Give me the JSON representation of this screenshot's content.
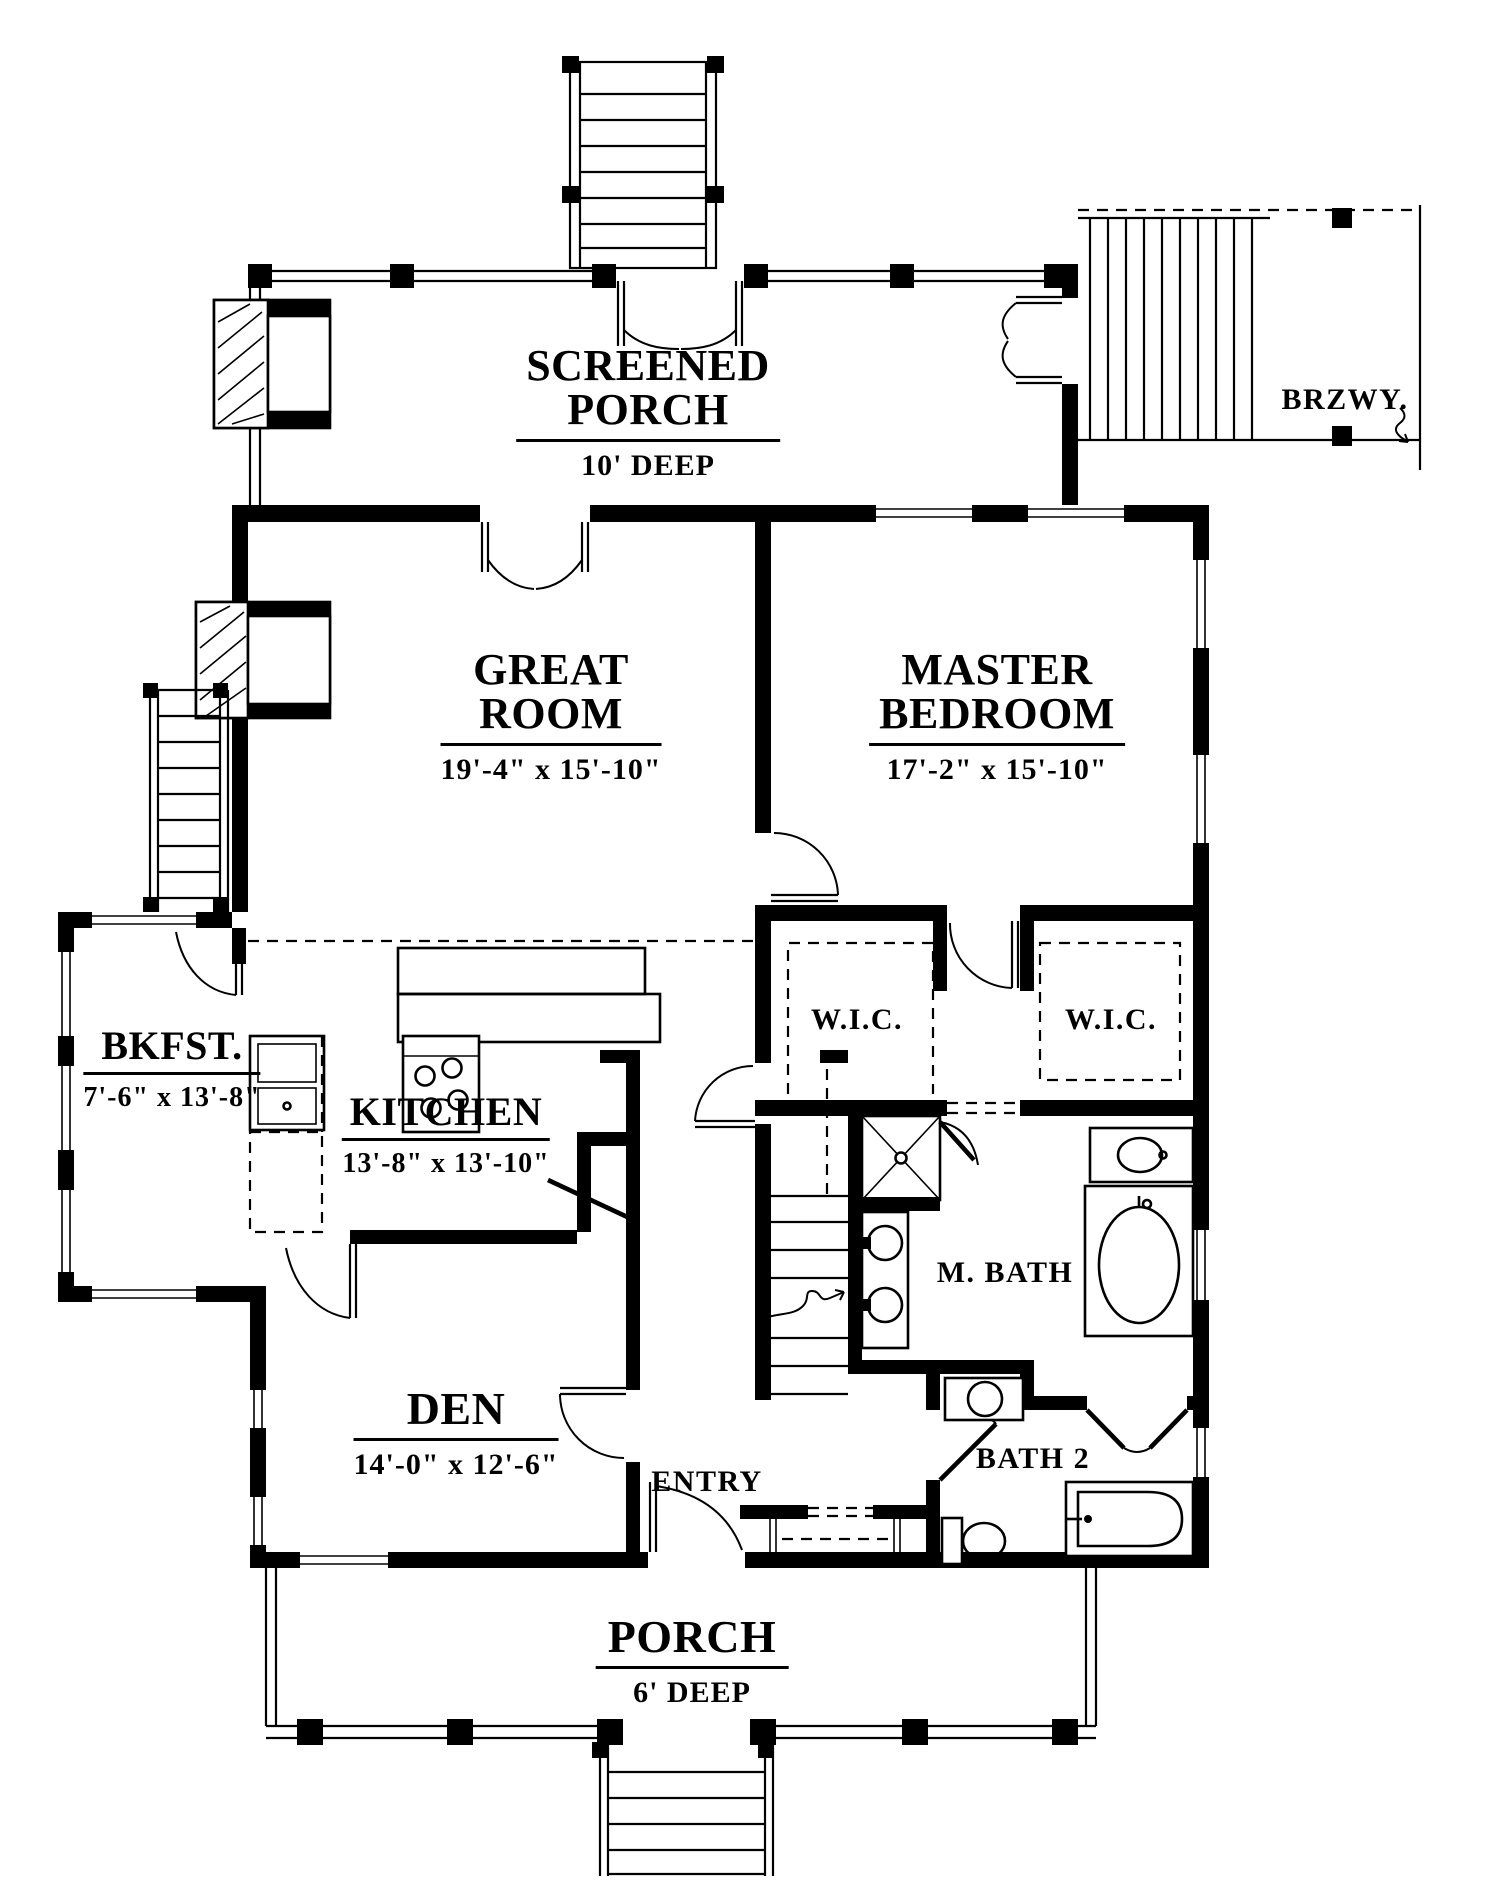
{
  "plan": {
    "colors": {
      "ink": "#000000",
      "paper": "#ffffff"
    },
    "rooms": {
      "screened_porch": {
        "line1": "SCREENED",
        "line2": "PORCH",
        "dims": "10' DEEP"
      },
      "brzwy": {
        "name": "BRZWY."
      },
      "great_room": {
        "line1": "GREAT",
        "line2": "ROOM",
        "dims": "19'-4\" x 15'-10\""
      },
      "master_bedroom": {
        "line1": "MASTER",
        "line2": "BEDROOM",
        "dims": "17'-2\" x 15'-10\""
      },
      "bkfst": {
        "name": "BKFST.",
        "dims": "7'-6\" x 13'-8\""
      },
      "kitchen": {
        "name": "KITCHEN",
        "dims": "13'-8\" x 13'-10\""
      },
      "wic_left": {
        "name": "W.I.C."
      },
      "wic_right": {
        "name": "W.I.C."
      },
      "master_bath": {
        "name": "M. BATH"
      },
      "den": {
        "name": "DEN",
        "dims": "14'-0\" x 12'-6\""
      },
      "entry": {
        "name": "ENTRY"
      },
      "bath_2": {
        "name": "BATH 2"
      },
      "porch": {
        "name": "PORCH",
        "dims": "6' DEEP"
      }
    }
  }
}
